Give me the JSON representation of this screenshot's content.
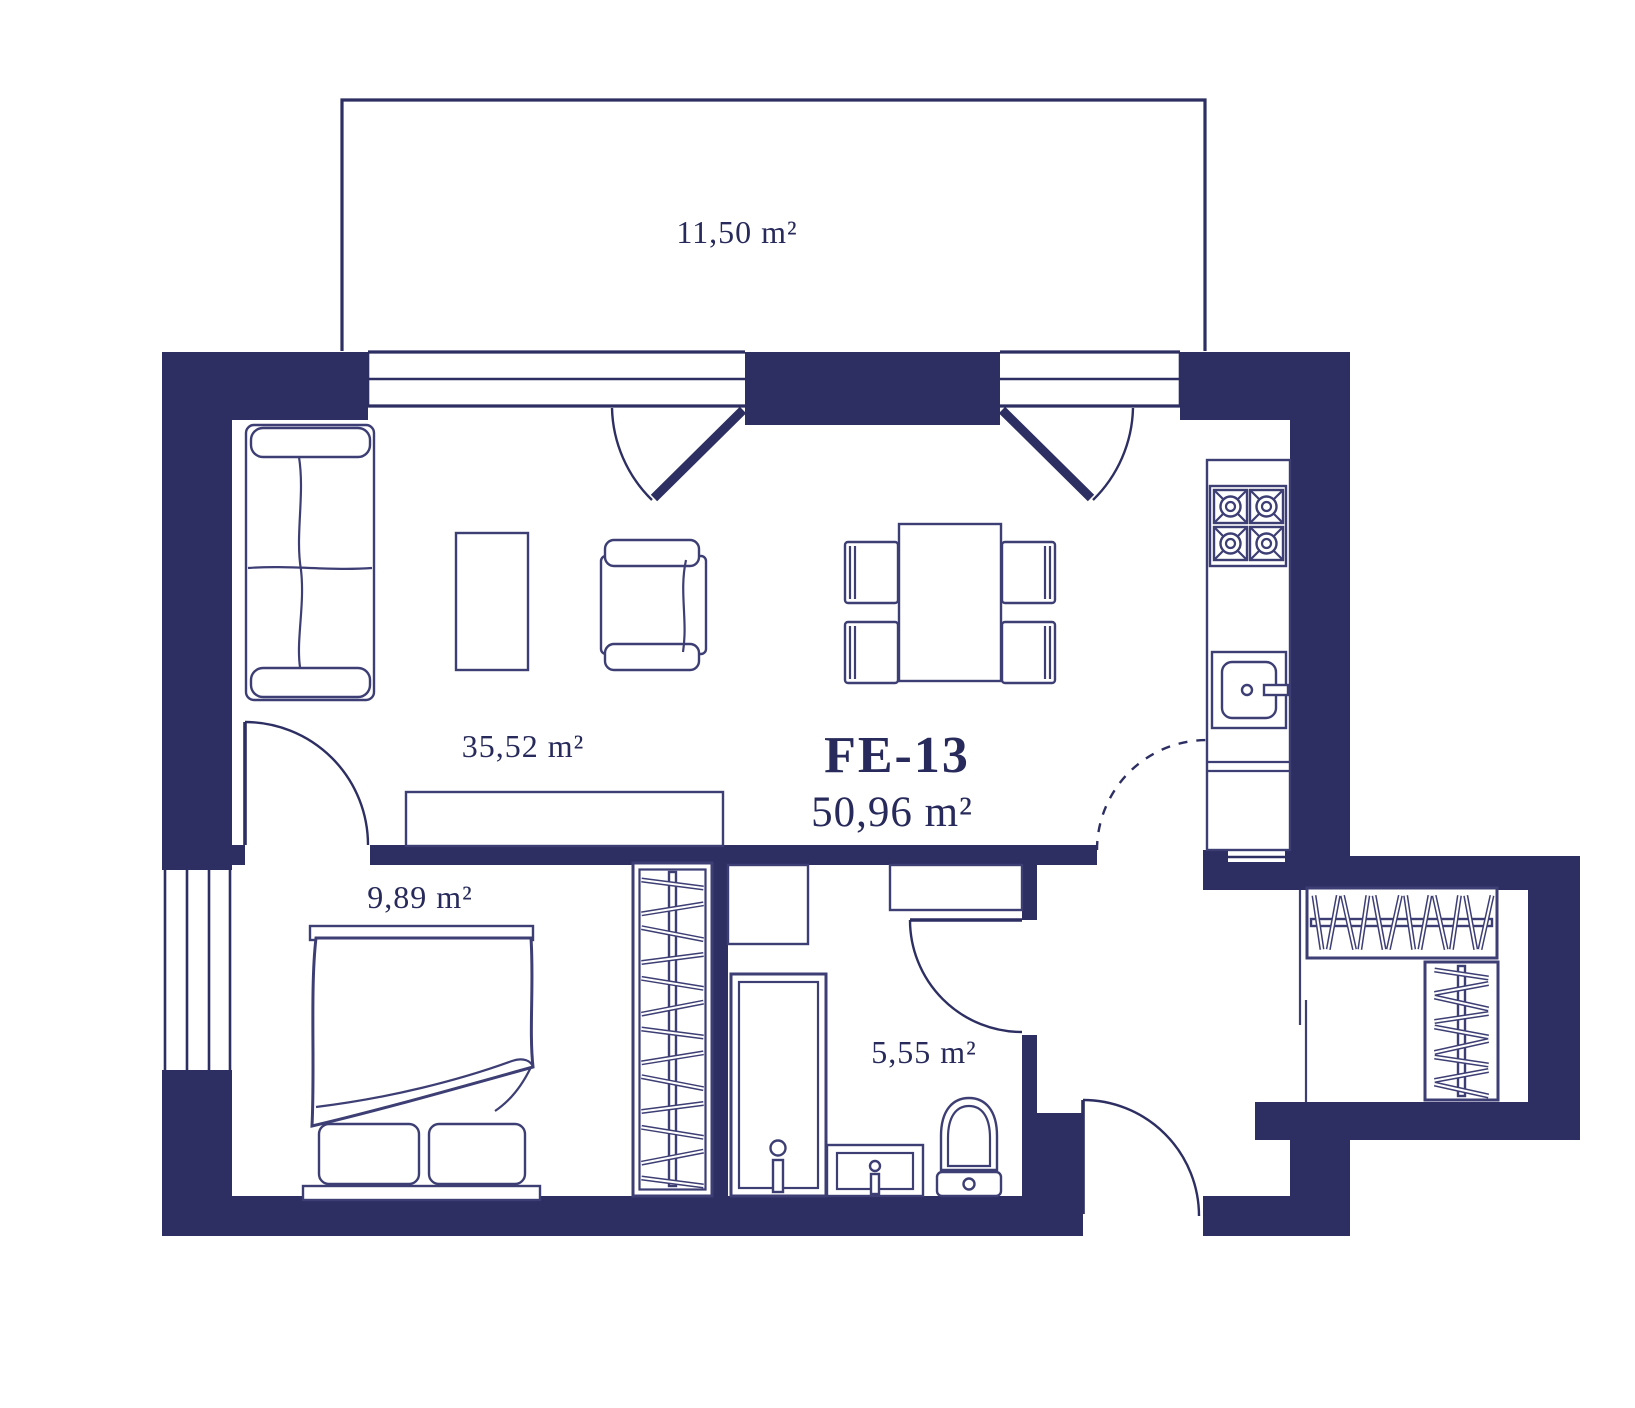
{
  "plan": {
    "unit": {
      "id": "FE-13",
      "total_area": "50,96 m²"
    },
    "rooms": [
      {
        "name": "balcony",
        "area": "11,50 m²"
      },
      {
        "name": "living-kitchen",
        "area": "35,52 m²"
      },
      {
        "name": "bedroom",
        "area": "9,89 m²"
      },
      {
        "name": "bathroom",
        "area": "5,55 m²"
      }
    ],
    "colors": {
      "wall": "#2d2e62",
      "line": "#3d3e74",
      "text": "#272a5a",
      "background": "#ffffff"
    }
  }
}
